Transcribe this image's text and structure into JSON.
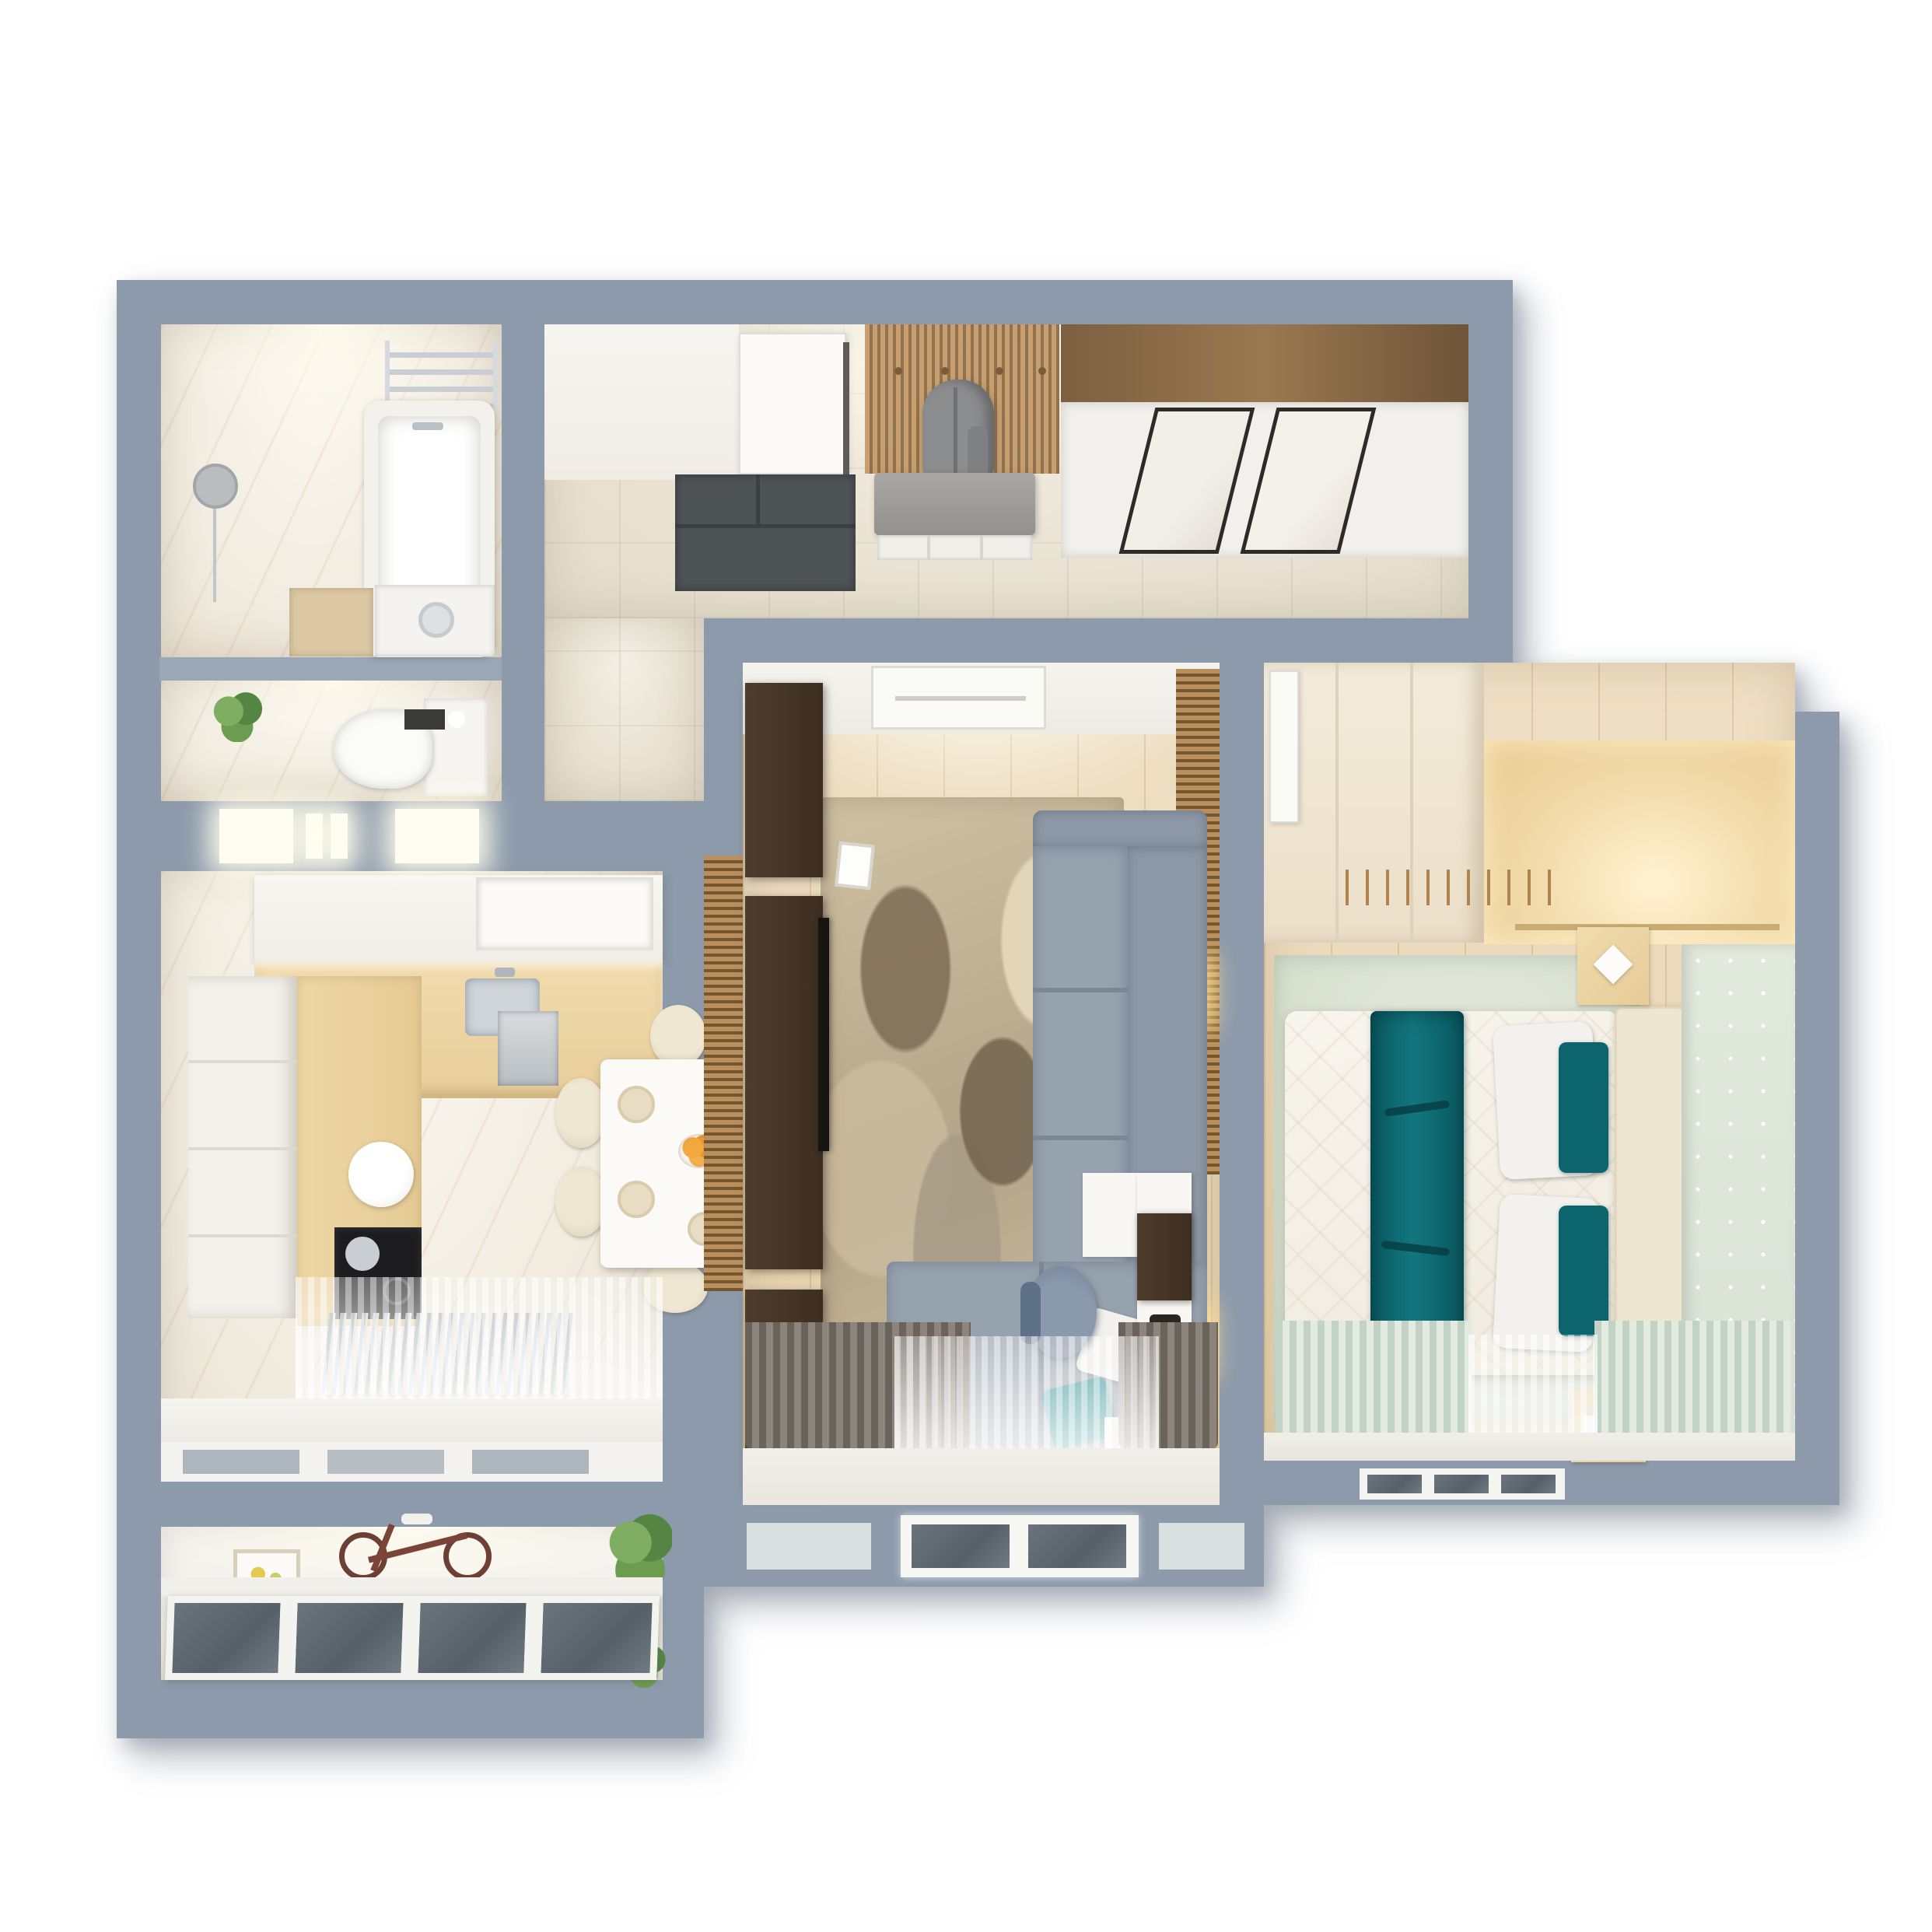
{
  "scene": {
    "kind": "3d-floor-plan-top-down-render",
    "background": "#ffffff"
  },
  "palette": {
    "wall": "#8c9aab",
    "wall_inner": "#9aa7b6",
    "hall_tile": "#eae3d4",
    "marble": "#f1ebdf",
    "wood_floor": "#e9d7b6",
    "slat_wood": "#b98f5e",
    "dark_cabinet": "#3f3124",
    "counter_wood": "#eacf9f",
    "sofa_gray": "#97a2af",
    "teal_accent": "#0d6a72",
    "sage_rug": "#dde4d5",
    "dot_wallpaper": "#dde5d8",
    "glow": "#fffdf2",
    "glass": "#5f6a73",
    "doormat": "#4e5356",
    "drape_taupe": "#6a635c",
    "drape_green": "#c2d2c4"
  },
  "rooms": {
    "bathroom": {
      "name": "bathroom",
      "furniture": [
        "bathtub",
        "towel-rack",
        "round-mirror",
        "vanity",
        "washing-machine"
      ]
    },
    "wc": {
      "name": "toilet-room",
      "furniture": [
        "wall-hung-toilet",
        "cistern",
        "paper-holder",
        "plant"
      ]
    },
    "hallway": {
      "name": "hallway",
      "furniture": [
        "entry-door",
        "doormat",
        "coat-rack-slats",
        "coat",
        "bench",
        "shoe-shelf",
        "sliding-wardrobe"
      ]
    },
    "kitchen": {
      "name": "kitchen",
      "furniture": [
        "l-shaped-counter",
        "hood",
        "sink",
        "cooktop",
        "kettle",
        "dining-table",
        "chairs",
        "fruit-bowl",
        "radiator",
        "sheer-curtain"
      ]
    },
    "living": {
      "name": "living-room",
      "furniture": [
        "corner-sofa",
        "pillows",
        "area-rug",
        "tv-wall-columns",
        "tv",
        "desk",
        "desk-chair",
        "wall-sconces",
        "slat-wall",
        "drapes",
        "window"
      ]
    },
    "bedroom": {
      "name": "bedroom",
      "furniture": [
        "double-bed",
        "teal-runner",
        "pillows",
        "headboard",
        "nightstands",
        "wardrobe-niche",
        "sconces",
        "sage-rug",
        "curtains",
        "window"
      ]
    },
    "balcony": {
      "name": "balcony",
      "furniture": [
        "glazing",
        "bicycle",
        "picture-frame",
        "plants"
      ]
    }
  }
}
